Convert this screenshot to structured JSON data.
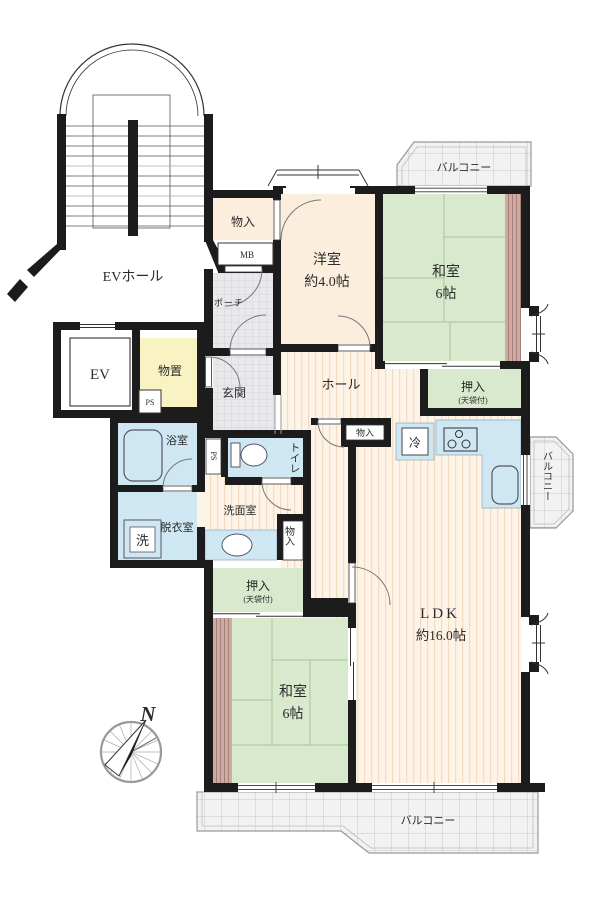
{
  "title": "apartment-floor-plan",
  "labels": {
    "ev_hall": "EVホール",
    "stor_top": "物入",
    "mb": "MB",
    "porch": "ポーチ",
    "west_room_name": "洋室",
    "west_room_size": "約4.0帖",
    "jp_room_top_name": "和室",
    "jp_room_top_size": "6帖",
    "balcony_top": "バルコニー",
    "ev": "EV",
    "storage": "物置",
    "ps_storage": "PS",
    "genkan": "玄関",
    "hall": "ホール",
    "oshiire_r_name": "押入",
    "oshiire_r_sub": "(天袋付)",
    "bath": "浴室",
    "ps_wc": "PS",
    "toilet": "トイレ",
    "wash_room": "洗面室",
    "dressing": "脱衣室",
    "washer": "洗",
    "stor_hall": "物入",
    "fridge": "冷",
    "balcony_right": "バルコニー",
    "stor_mid": "物入",
    "oshiire_b_name": "押入",
    "oshiire_b_sub": "(天袋付)",
    "jp_room_b_name": "和室",
    "jp_room_b_size": "6帖",
    "ldk_name": "LDK",
    "ldk_size": "約16.0帖",
    "balcony_bottom": "バルコニー",
    "compass_n": "N"
  },
  "colors": {
    "wall": "#1c1c1c",
    "cream": "#fbeedd",
    "wood_bg": "#fdf3e6",
    "wood_line": "#f3ddc2",
    "tatami": "#d9e9cd",
    "tatami_line": "#a9c296",
    "water_blue": "#cfe7f3",
    "storage_yellow": "#f9f3c4",
    "tile": "#e9e9ec",
    "tile_line": "#cfcfd4",
    "balcony": "#f2f2f2",
    "balcony_line": "#c9c9c9",
    "edge_brown": "#cfaaa1",
    "edge_brown_line": "#a5807a"
  }
}
